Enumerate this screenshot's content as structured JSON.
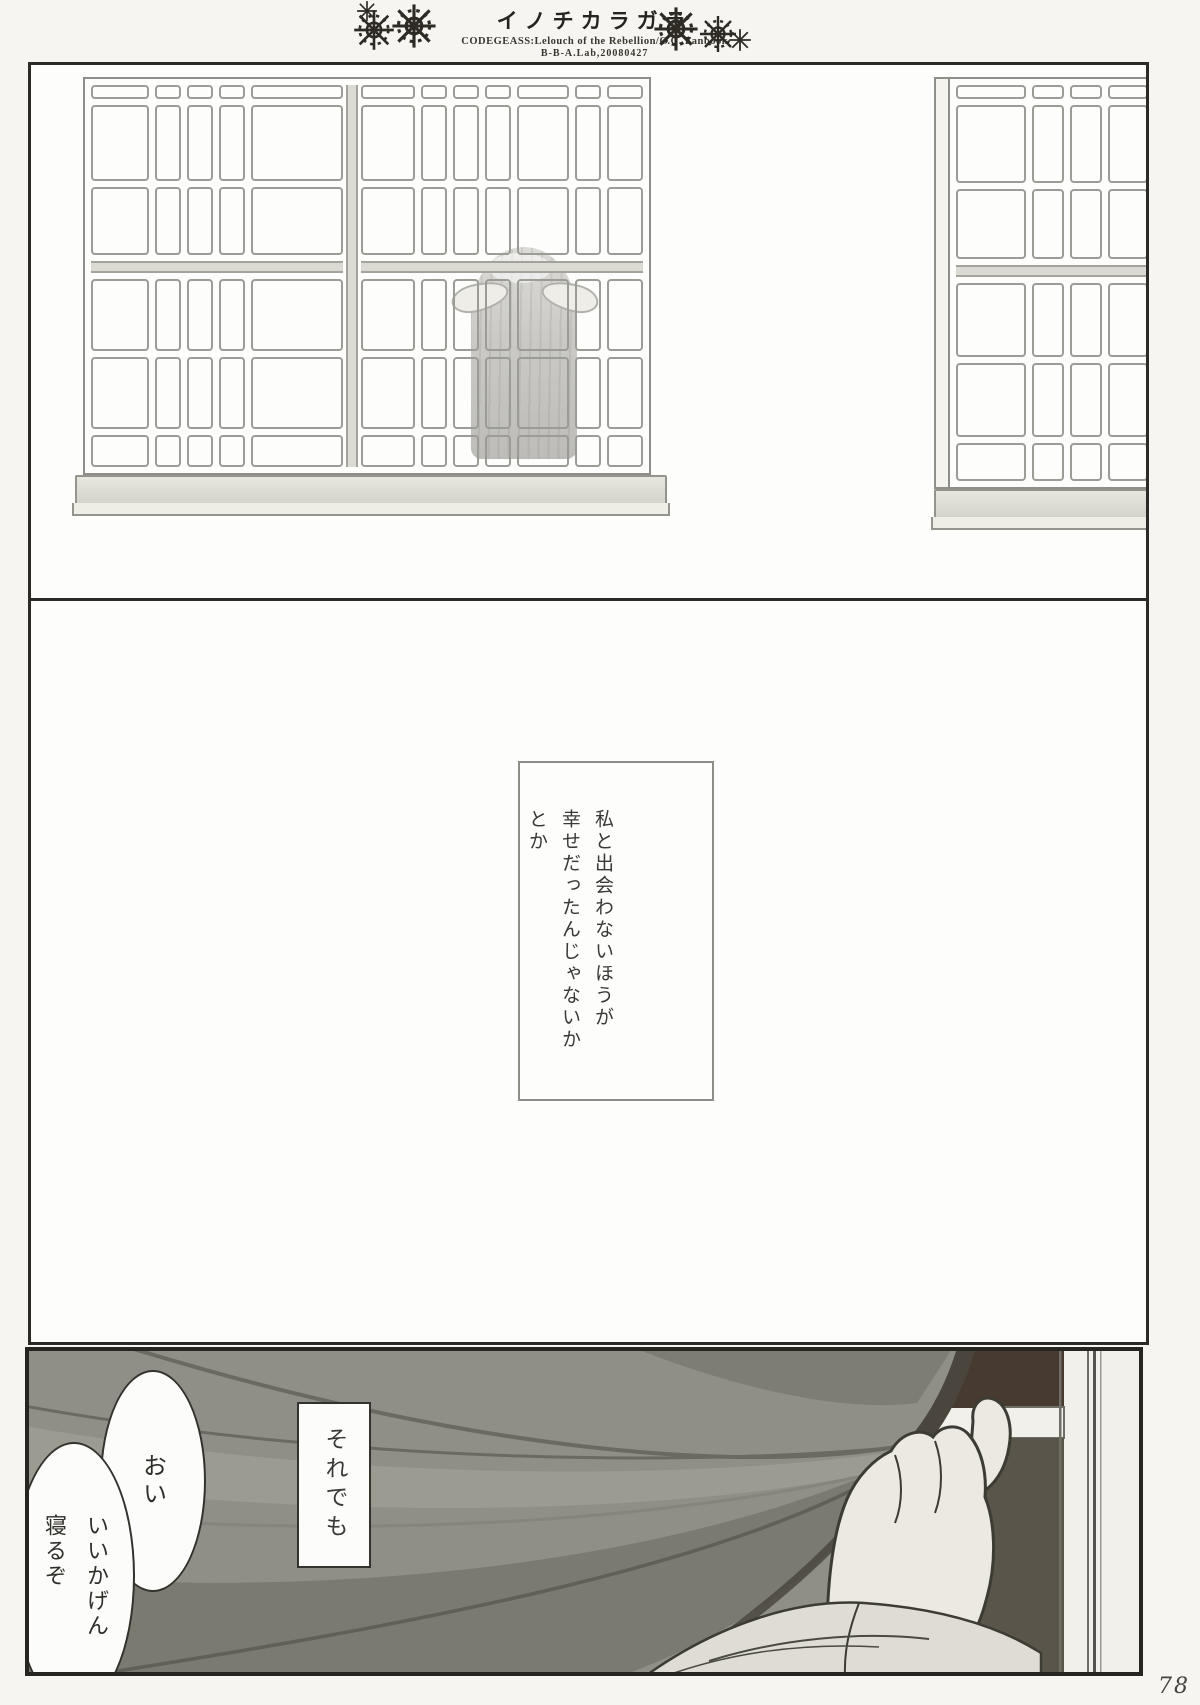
{
  "header": {
    "title": "イノチカラガラ",
    "subtitle": "CODEGEASS:Lelouch of the Rebellion/C.C. Fanbook",
    "credit": "B-B-A.Lab,20080427",
    "ornament_icon": "snowflake"
  },
  "panels": {
    "window_scene": {
      "description": "figure-with-long-hair-behind-latticed-window"
    },
    "monologue": {
      "lines": [
        "私と出会わないほうが",
        "幸せだったんじゃないか",
        "とか"
      ]
    },
    "curtain_scene": {
      "caption": "それでも",
      "bubble_oi": "おい",
      "bubble_sleep_lines": [
        "いいかげん",
        "寝るぞ"
      ]
    }
  },
  "page_number": "78",
  "colors": {
    "panel_border": "#2b2a26",
    "window_line": "#9c9c96",
    "curtain": "#908f87",
    "curtain_shadow": "#7b7a71",
    "curtain_edge": "#4a463e",
    "dark_corner": "#463a31",
    "hand": "#ebe9e1",
    "sleeve": "#dfddd3",
    "paper": "#f6f5f1"
  }
}
